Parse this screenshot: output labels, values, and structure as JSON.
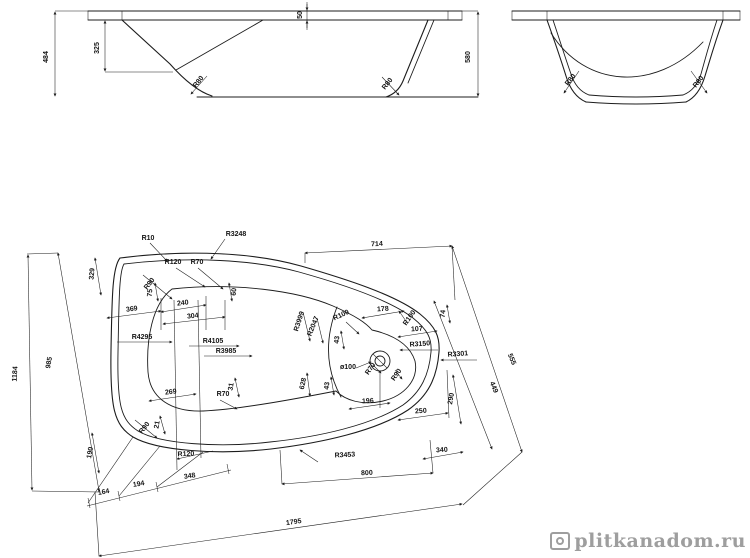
{
  "watermark": {
    "text": "plitkanadom.ru"
  },
  "front_view": {
    "labels": {
      "overall_height": "484",
      "inner_depth": "325",
      "rim_thickness": "50",
      "right_height": "580",
      "radius_left": "R80",
      "radius_right": "R80"
    }
  },
  "side_view": {
    "labels": {
      "radius_left": "R80",
      "radius_right": "R80"
    }
  },
  "plan_view": {
    "labels": [
      "R10",
      "R3248",
      "714",
      "329",
      "R120",
      "R70",
      "R90",
      "75",
      "60",
      "369",
      "240",
      "304",
      "R4295",
      "R4105",
      "R3985",
      "R3999",
      "R2047",
      "R100",
      "178",
      "R100",
      "74",
      "107",
      "R3150",
      "R3301",
      "555",
      "43",
      "ø100",
      "R70",
      "R90",
      "628",
      "43",
      "196",
      "250",
      "290",
      "449",
      "31",
      "269",
      "R70",
      "R90",
      "21",
      "R120",
      "190",
      "R3453",
      "340",
      "194",
      "348",
      "164",
      "800",
      "1795",
      "985",
      "1184"
    ]
  }
}
